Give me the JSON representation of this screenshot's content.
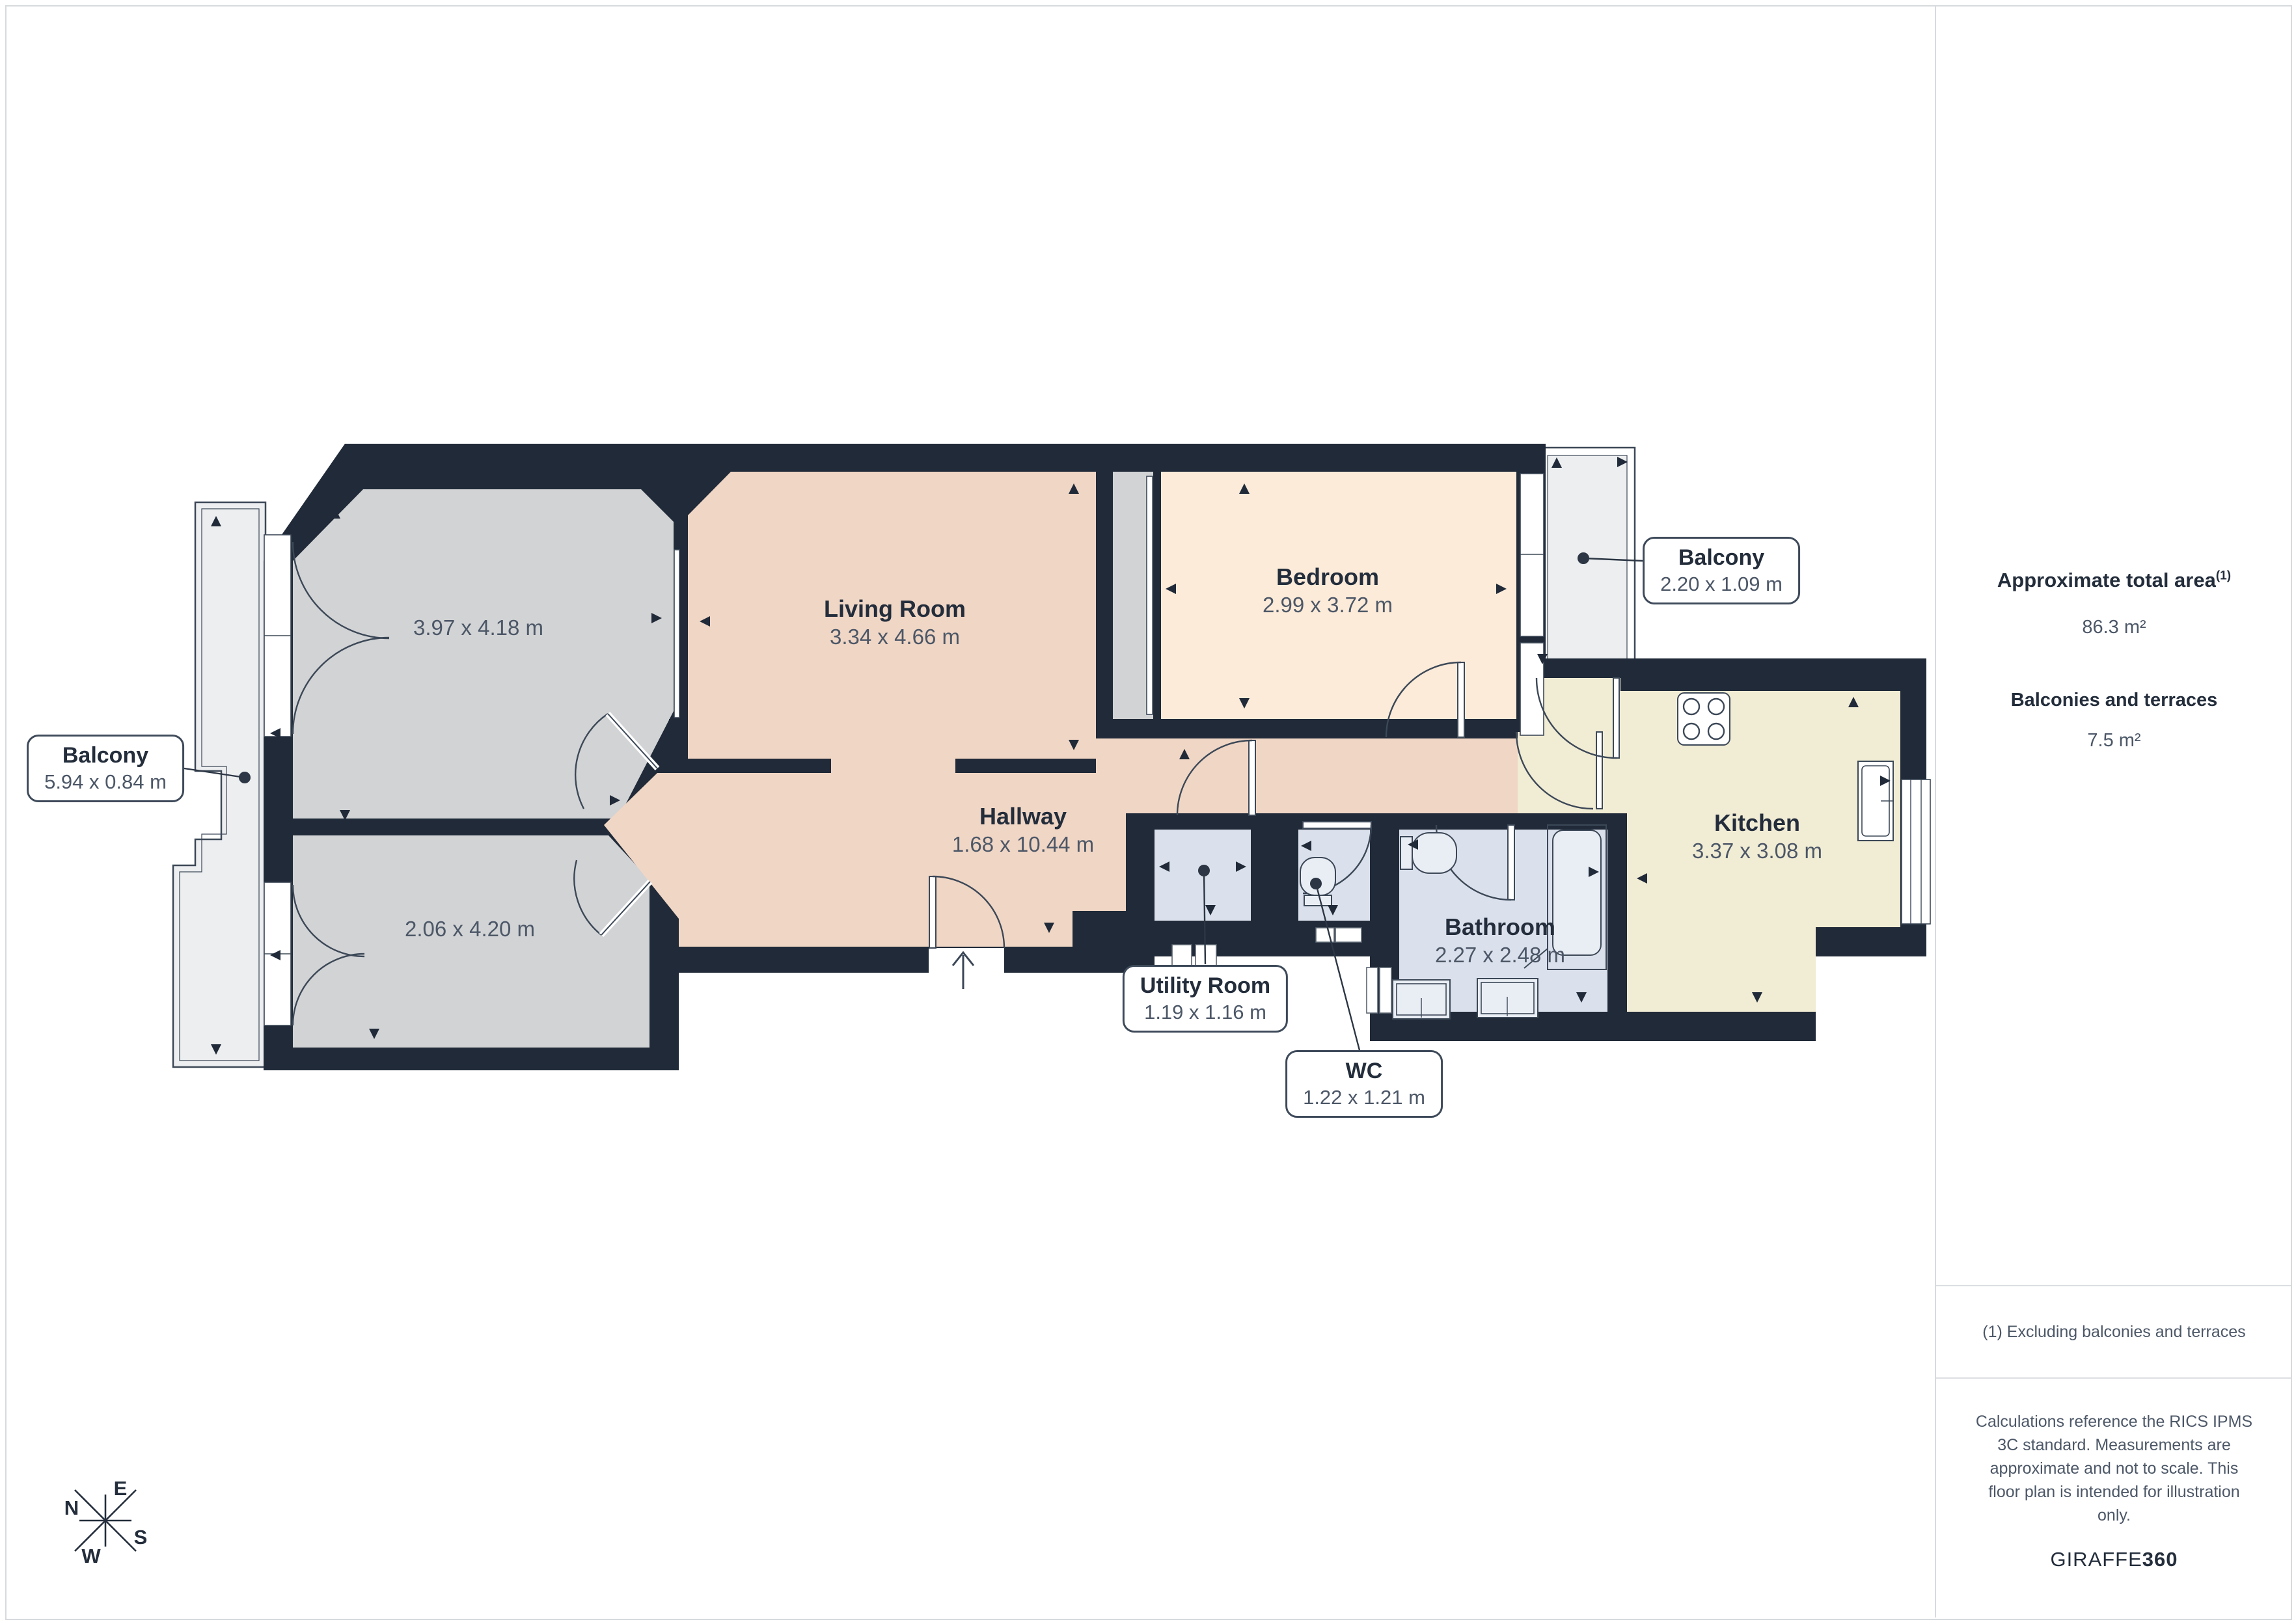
{
  "plan": {
    "rooms": [
      {
        "name": "Living Room",
        "dims": "3.34 x 4.66 m"
      },
      {
        "name": "Bedroom",
        "dims": "2.99 x 3.72 m"
      },
      {
        "name": "Hallway",
        "dims": "1.68 x 10.44 m"
      },
      {
        "name": "Kitchen",
        "dims": "3.37 x 3.08 m"
      },
      {
        "name": "Bathroom",
        "dims": "2.27 x 2.48 m"
      },
      {
        "dims": "3.97 x 4.18 m"
      },
      {
        "dims": "2.06 x 4.20 m"
      }
    ],
    "callouts": [
      {
        "name": "Balcony",
        "dims": "5.94 x 0.84 m"
      },
      {
        "name": "Balcony",
        "dims": "2.20 x 1.09 m"
      },
      {
        "name": "Utility Room",
        "dims": "1.19 x 1.16 m"
      },
      {
        "name": "WC",
        "dims": "1.22 x 1.21 m"
      }
    ],
    "compass": {
      "n": "N",
      "e": "E",
      "s": "S",
      "w": "W"
    }
  },
  "sidebar": {
    "total_area_label": "Approximate total area",
    "total_area_sup": "(1)",
    "total_area_value": "86.3 m²",
    "balconies_label": "Balconies and terraces",
    "balconies_value": "7.5 m²",
    "footnote": "(1) Excluding balconies and terraces",
    "disclaimer": "Calculations reference the RICS IPMS 3C standard. Measurements are approximate and not to scale. This floor plan is intended for illustration only.",
    "brand_name": "GIRAFFE",
    "brand_suffix": "360"
  },
  "colors": {
    "wall": "#202a38",
    "floor_living": "#f0d6c5",
    "floor_bedroom": "#fcebd9",
    "floor_kitchen": "#f1ecd4",
    "floor_gray": "#d2d3d5",
    "floor_wet": "#dbe1ec",
    "fixture": "#e9edf4",
    "balcony": "#eceef0",
    "outline": "#3c4857",
    "leader": "#2c3644",
    "text_dark": "#232d3b",
    "text_dim": "#4c5767",
    "border_light": "#d7dadd"
  }
}
